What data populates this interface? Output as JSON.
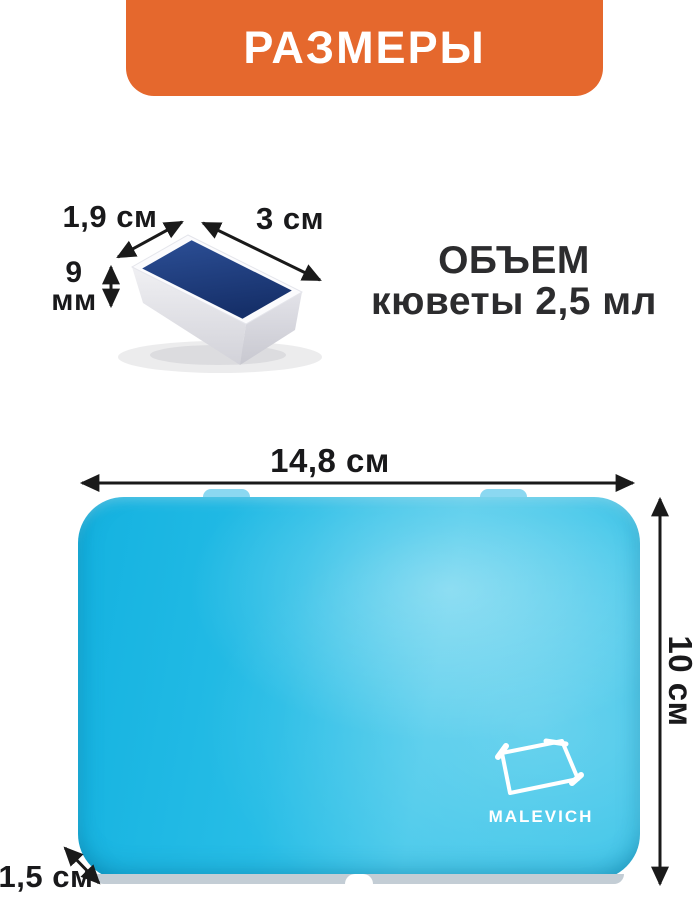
{
  "banner": {
    "title": "РАЗМЕРЫ",
    "bg_color": "#e5682d",
    "text_color": "#ffffff"
  },
  "cuvette": {
    "width_label": "1,9 см",
    "length_label": "3 см",
    "depth_value": "9",
    "depth_unit": "мм",
    "paint_color": "#1f3d7d",
    "pan_color": "#fbfbfd"
  },
  "volume": {
    "line1": "ОБЪЕМ",
    "line2": "кюветы 2,5 мл"
  },
  "tin": {
    "width_label": "14,8 см",
    "height_label": "10 см",
    "thickness_label": "1,5 см",
    "brand": "MALEVICH",
    "body_color": "#27bde6",
    "highlight_color": "#6fcdee"
  },
  "arrows": {
    "color": "#1a1a1a"
  }
}
